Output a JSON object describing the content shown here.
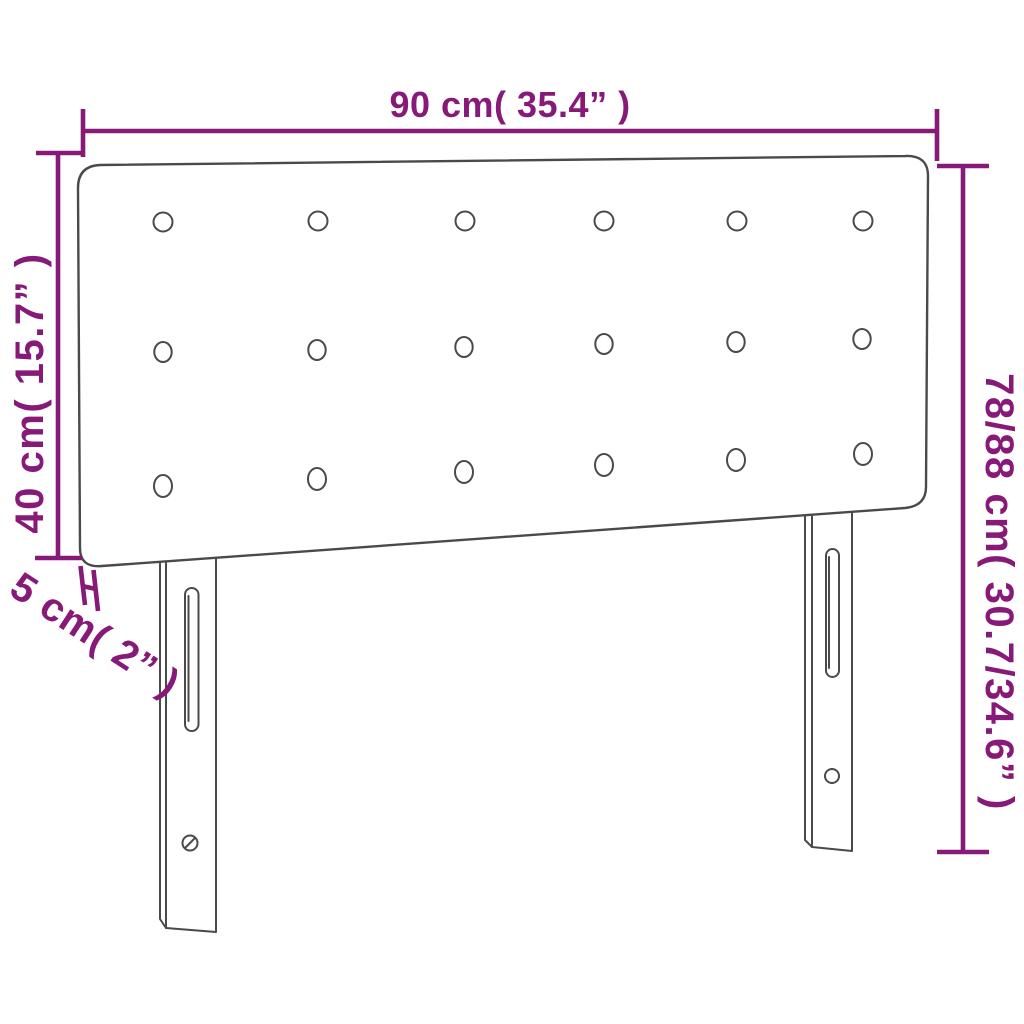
{
  "diagram": {
    "product": "headboard-dimension-diagram",
    "labels": {
      "width": "90 cm( 35.4” )",
      "panel_height": "40 cm( 15.7” )",
      "thickness": "5 cm( 2” )",
      "total_height": "78/88 cm( 30.7/34.6” )"
    },
    "values": {
      "width_cm": 90,
      "width_in": 35.4,
      "panel_height_cm": 40,
      "panel_height_in": 15.7,
      "thickness_cm": 5,
      "thickness_in": 2,
      "total_height_cm": "78/88",
      "total_height_in": "30.7/34.6"
    },
    "colors": {
      "dimension": "#871a78",
      "outline": "#4a4a4a",
      "background": "#ffffff"
    }
  }
}
